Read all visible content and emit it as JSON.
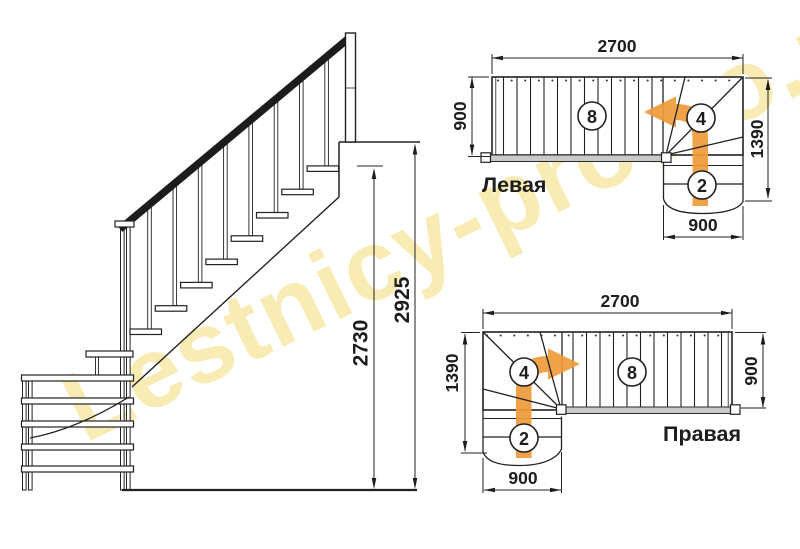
{
  "watermark": {
    "text": "Lestnicy-prosto.ru",
    "color": "rgba(242,219,116,0.55)"
  },
  "colors": {
    "line": "#222222",
    "orange": "#ef9b3a",
    "strip": "#c9c9c9"
  },
  "side_view": {
    "dim_flight": "2730",
    "dim_total": "2925"
  },
  "plans": {
    "left": {
      "label": "Левая",
      "dim_top": "2700",
      "dim_width": "900",
      "dim_height": "1390",
      "dim_bottom": "900",
      "straight_count": "8",
      "winder_count": "4",
      "lower_count": "2"
    },
    "right": {
      "label": "Правая",
      "dim_top": "2700",
      "dim_width": "900",
      "dim_height": "1390",
      "dim_bottom": "900",
      "straight_count": "8",
      "winder_count": "4",
      "lower_count": "2"
    }
  }
}
